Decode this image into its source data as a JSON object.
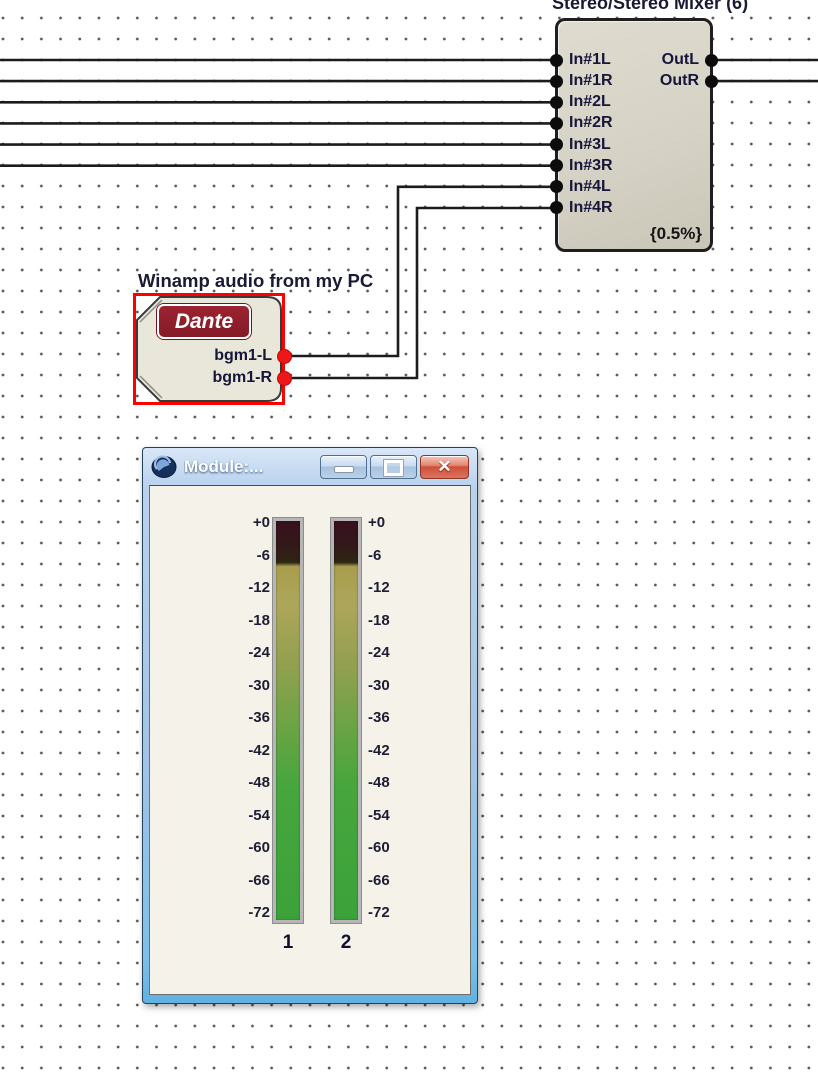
{
  "mixer": {
    "title": "Stereo/Stereo Mixer (6)",
    "inputs": [
      "In#1L",
      "In#1R",
      "In#2L",
      "In#2R",
      "In#3L",
      "In#3R",
      "In#4L",
      "In#4R"
    ],
    "outputs": [
      "OutL",
      "OutR"
    ],
    "dsp_load": "{0.5%}"
  },
  "dante": {
    "caption": "Winamp audio from my PC",
    "logo_text": "Dante",
    "logo_color": "#8e1d2a",
    "ports": [
      "bgm1-L",
      "bgm1-R"
    ],
    "port_color": "#ee1616",
    "selected": true,
    "selection_color": "#ff0000"
  },
  "meter_window": {
    "title": "Module:...",
    "window_buttons": [
      "minimize",
      "maximize",
      "close"
    ],
    "scale_labels": [
      "+0",
      "-6",
      "-12",
      "-18",
      "-24",
      "-30",
      "-36",
      "-42",
      "-48",
      "-54",
      "-60",
      "-66",
      "-72"
    ],
    "channels": [
      "1",
      "2"
    ],
    "levels_db": [
      -8,
      -8
    ],
    "scale_min_db": -72,
    "scale_max_db": 0
  }
}
